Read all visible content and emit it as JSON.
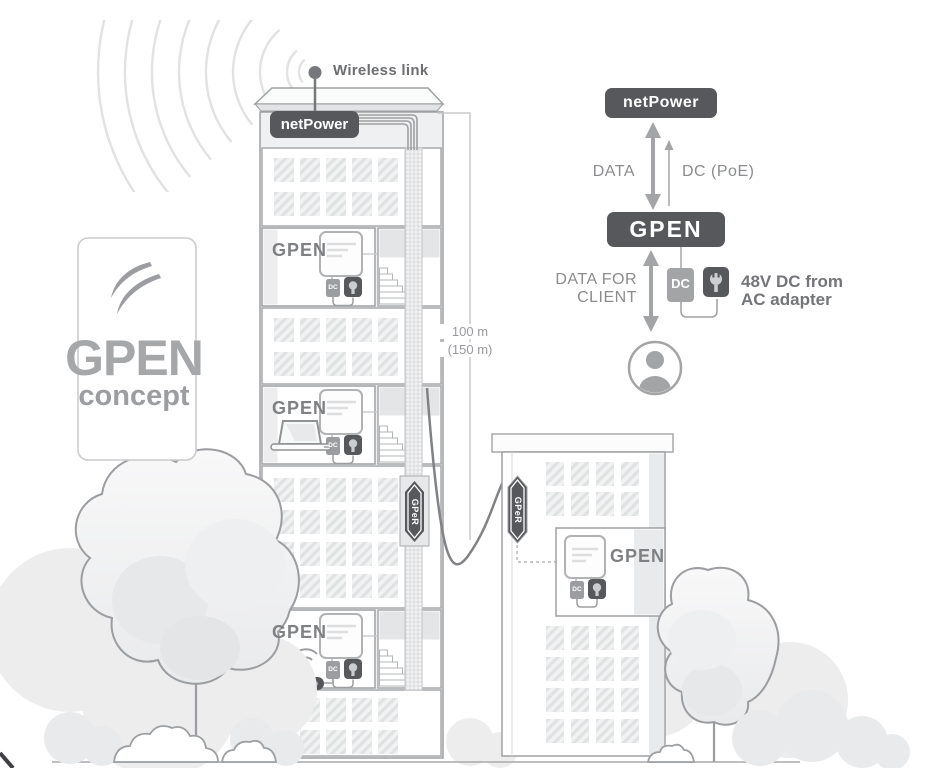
{
  "colors": {
    "accent_dark": "#57585c",
    "mid_gray": "#a2a4a6",
    "outline_gray": "#9da0a2",
    "text_gray": "#87898c",
    "light_fill": "#eff0f1"
  },
  "logo_card": {
    "title": "GPEN",
    "subtitle": "concept"
  },
  "tower": {
    "wireless_link_label": "Wireless link",
    "netpower_label": "netPower",
    "floor_unit_label": "GPEN",
    "riser_label": "GPeR",
    "mini_dc_label": "DC"
  },
  "cable": {
    "length_label": "100 m",
    "length_alt_label": "(150 m)"
  },
  "building2": {
    "unit_label": "GPEN",
    "riser_label": "GPeR",
    "mini_dc_label": "DC"
  },
  "schematic": {
    "netpower_label": "netPower",
    "gpen_label": "GPEN",
    "down_label": "DATA",
    "up_label": "DC (PoE)",
    "client_line1": "DATA FOR",
    "client_line2": "CLIENT",
    "dc_label": "DC",
    "power_line1": "48V DC from",
    "power_line2": "AC adapter"
  }
}
